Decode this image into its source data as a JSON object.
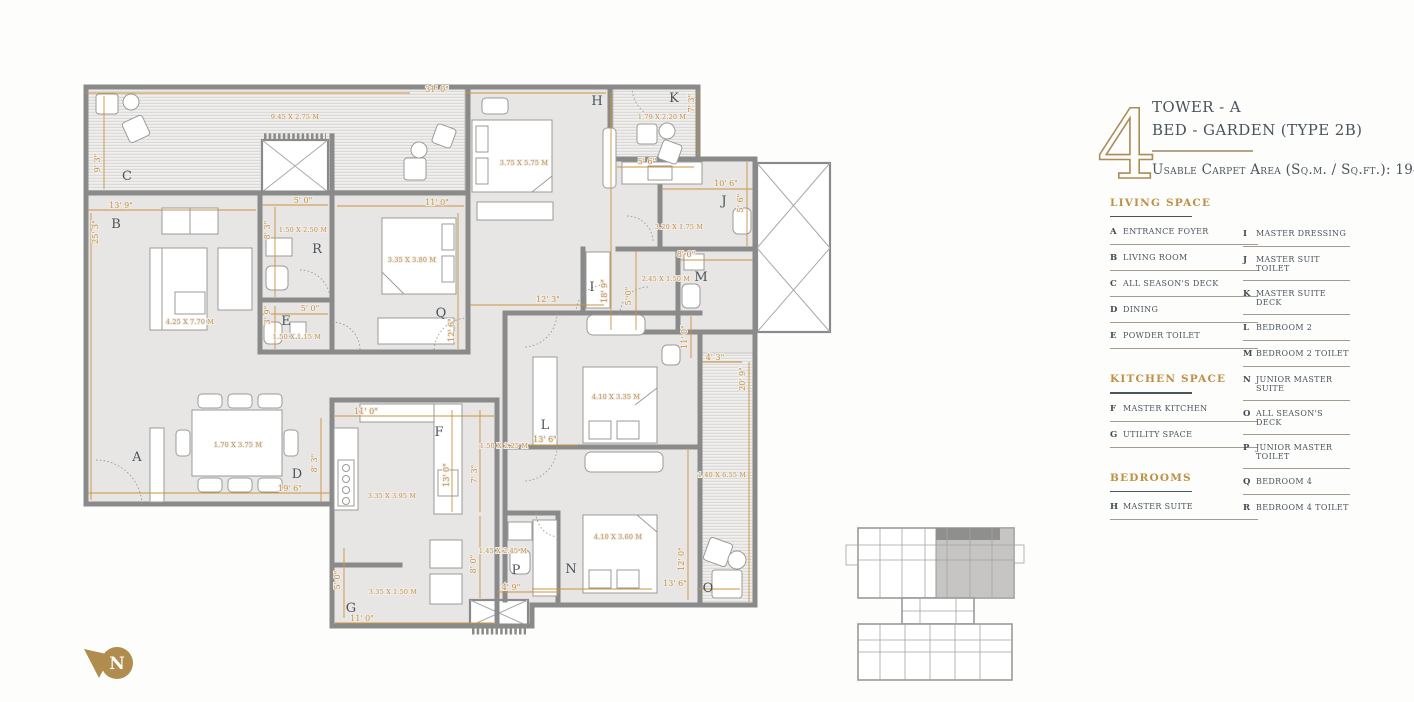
{
  "title_block": {
    "unit_number": "4",
    "line1": "TOWER - A",
    "line2": "BED - GARDEN (TYPE 2B)",
    "area_line": "Usable Carpet Area (Sq.m. / Sq.ft.): 194 / 2089"
  },
  "legend": {
    "column1": [
      {
        "heading": "LIVING SPACE",
        "items": [
          {
            "key": "A",
            "label": "ENTRANCE FOYER"
          },
          {
            "key": "B",
            "label": "LIVING ROOM"
          },
          {
            "key": "C",
            "label": "ALL SEASON'S DECK"
          },
          {
            "key": "D",
            "label": "DINING"
          },
          {
            "key": "E",
            "label": "POWDER TOILET"
          }
        ]
      },
      {
        "heading": "KITCHEN SPACE",
        "items": [
          {
            "key": "F",
            "label": "MASTER KITCHEN"
          },
          {
            "key": "G",
            "label": "UTILITY SPACE"
          }
        ]
      },
      {
        "heading": "BEDROOMS",
        "items": [
          {
            "key": "H",
            "label": "MASTER SUITE"
          }
        ]
      }
    ],
    "column2": [
      {
        "heading": null,
        "items": [
          {
            "key": "I",
            "label": "MASTER DRESSING"
          },
          {
            "key": "J",
            "label": "MASTER SUIT TOILET"
          },
          {
            "key": "K",
            "label": "MASTER SUITE DECK"
          },
          {
            "key": "L",
            "label": "BEDROOM 2"
          },
          {
            "key": "M",
            "label": "BEDROOM 2 TOILET"
          },
          {
            "key": "N",
            "label": "JUNIOR MASTER SUITE"
          },
          {
            "key": "O",
            "label": "ALL SEASON'S DECK"
          },
          {
            "key": "P",
            "label": "JUNIOR MASTER TOILET"
          },
          {
            "key": "Q",
            "label": "BEDROOM 4"
          },
          {
            "key": "R",
            "label": "BEDROOM 4 TOILET"
          }
        ]
      }
    ]
  },
  "plan": {
    "north_label": "N",
    "colors": {
      "dimension_gold": "#c8913f",
      "accent_gold": "#b08d4f",
      "wall_gray": "#8a8a8a",
      "text_slate": "#4a545c"
    },
    "room_labels": [
      {
        "id": "A",
        "x": 137,
        "y": 461
      },
      {
        "id": "B",
        "x": 116,
        "y": 228
      },
      {
        "id": "C",
        "x": 127,
        "y": 180
      },
      {
        "id": "D",
        "x": 297,
        "y": 478
      },
      {
        "id": "E",
        "x": 286,
        "y": 325
      },
      {
        "id": "F",
        "x": 439,
        "y": 436
      },
      {
        "id": "G",
        "x": 351,
        "y": 612
      },
      {
        "id": "H",
        "x": 597,
        "y": 105
      },
      {
        "id": "I",
        "x": 592,
        "y": 291
      },
      {
        "id": "J",
        "x": 724,
        "y": 205
      },
      {
        "id": "K",
        "x": 674,
        "y": 102
      },
      {
        "id": "L",
        "x": 545,
        "y": 429
      },
      {
        "id": "M",
        "x": 701,
        "y": 281
      },
      {
        "id": "N",
        "x": 571,
        "y": 573
      },
      {
        "id": "O",
        "x": 708,
        "y": 592
      },
      {
        "id": "P",
        "x": 516,
        "y": 574
      },
      {
        "id": "Q",
        "x": 441,
        "y": 317
      },
      {
        "id": "R",
        "x": 317,
        "y": 253
      }
    ],
    "dimensions": [
      {
        "t": "31' 0\"",
        "x": 437,
        "y": 92
      },
      {
        "t": "9' 3\"",
        "x": 100,
        "y": 163,
        "r": -90
      },
      {
        "t": "13' 9\"",
        "x": 121,
        "y": 208
      },
      {
        "t": "25' 3\"",
        "x": 98,
        "y": 232,
        "r": -90
      },
      {
        "t": "5' 0\"",
        "x": 303,
        "y": 203
      },
      {
        "t": "8' 3\"",
        "x": 270,
        "y": 230,
        "r": -90
      },
      {
        "t": "5' 0\"",
        "x": 310,
        "y": 311
      },
      {
        "t": "3' 9\"",
        "x": 270,
        "y": 315,
        "r": -90
      },
      {
        "t": "11' 0\"",
        "x": 437,
        "y": 205
      },
      {
        "t": "12' 6\"",
        "x": 454,
        "y": 330,
        "r": -90
      },
      {
        "t": "7' 3\"",
        "x": 694,
        "y": 103,
        "r": -90
      },
      {
        "t": "5' 6\"",
        "x": 647,
        "y": 164
      },
      {
        "t": "10' 6\"",
        "x": 726,
        "y": 186
      },
      {
        "t": "5' 6\"",
        "x": 743,
        "y": 203,
        "r": -90
      },
      {
        "t": "8' 0\"",
        "x": 686,
        "y": 257
      },
      {
        "t": "5' 0\"",
        "x": 631,
        "y": 296,
        "r": -90
      },
      {
        "t": "18' 9\"",
        "x": 607,
        "y": 291,
        "r": -90
      },
      {
        "t": "12' 3\"",
        "x": 548,
        "y": 302
      },
      {
        "t": "11' 0\"",
        "x": 687,
        "y": 337,
        "r": -90
      },
      {
        "t": "4' 3\"",
        "x": 715,
        "y": 360
      },
      {
        "t": "20' 9\"",
        "x": 745,
        "y": 379,
        "r": -90
      },
      {
        "t": "12' 0\"",
        "x": 684,
        "y": 559,
        "r": -90
      },
      {
        "t": "13' 6\"",
        "x": 675,
        "y": 586
      },
      {
        "t": "11' 0\"",
        "x": 366,
        "y": 414
      },
      {
        "t": "8' 3\"",
        "x": 317,
        "y": 463,
        "r": -90
      },
      {
        "t": "13' 0\"",
        "x": 449,
        "y": 475,
        "r": -90
      },
      {
        "t": "7' 3\"",
        "x": 477,
        "y": 474,
        "r": -90
      },
      {
        "t": "13' 6\"",
        "x": 545,
        "y": 442
      },
      {
        "t": "8' 0\"",
        "x": 476,
        "y": 564,
        "r": -90
      },
      {
        "t": "4' 9\"",
        "x": 511,
        "y": 590
      },
      {
        "t": "5' 0\"",
        "x": 340,
        "y": 580,
        "r": -90
      },
      {
        "t": "11' 0\"",
        "x": 362,
        "y": 621
      },
      {
        "t": "19' 6\"",
        "x": 290,
        "y": 491
      }
    ],
    "room_sizes": [
      {
        "t": "9.45 X 2.75 M",
        "x": 295,
        "y": 119
      },
      {
        "t": "1.50 X 2.50 M",
        "x": 303,
        "y": 232
      },
      {
        "t": "1.50 X 1.15 M",
        "x": 297,
        "y": 339
      },
      {
        "t": "4.25 X 7.70 M",
        "x": 190,
        "y": 324
      },
      {
        "t": "3.35 X 3.80 M",
        "x": 412,
        "y": 262
      },
      {
        "t": "3.75 X 5.75 M",
        "x": 524,
        "y": 165
      },
      {
        "t": "1.79 X 2.20 M",
        "x": 662,
        "y": 119
      },
      {
        "t": "3.20 X 1.75 M",
        "x": 679,
        "y": 229
      },
      {
        "t": "2.45 X 1.50 M",
        "x": 666,
        "y": 281
      },
      {
        "t": "1.40 X 6.55 M",
        "x": 722,
        "y": 477
      },
      {
        "t": "1.50 X 2.25 M",
        "x": 504,
        "y": 448
      },
      {
        "t": "3.35 X 3.95 M",
        "x": 392,
        "y": 498
      },
      {
        "t": "4.10 X 3.35 M",
        "x": 616,
        "y": 399
      },
      {
        "t": "4.10 X 3.60 M",
        "x": 618,
        "y": 539
      },
      {
        "t": "1.45 X 2.45 M",
        "x": 503,
        "y": 553
      },
      {
        "t": "3.35 X 1.50 M",
        "x": 393,
        "y": 594
      },
      {
        "t": "1.70 X 3.75 M",
        "x": 238,
        "y": 447
      }
    ]
  }
}
